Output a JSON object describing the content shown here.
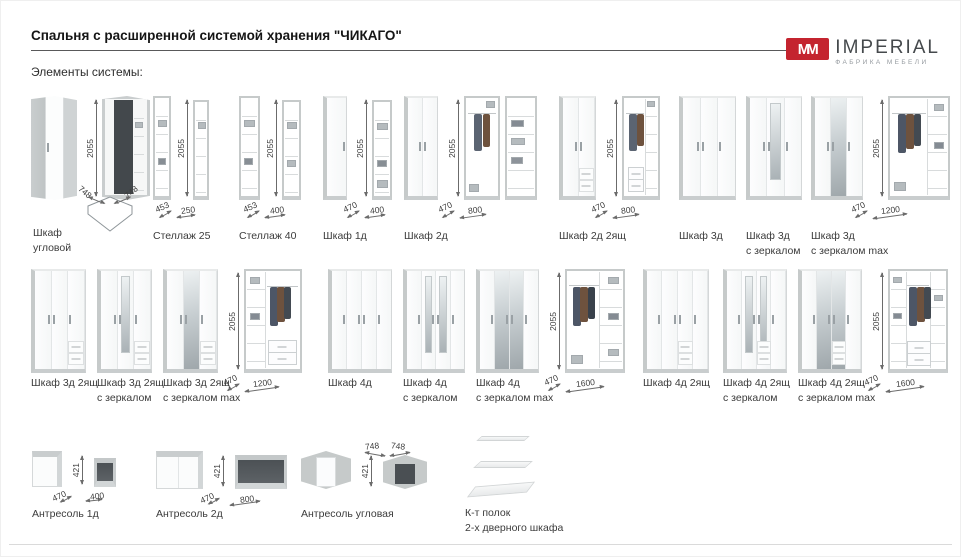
{
  "header": {
    "title": "Спальня с расширенной системой хранения \"ЧИКАГО\"",
    "subtitle": "Элементы системы:"
  },
  "brand": {
    "mark": "MM",
    "name": "IMPERIAL",
    "tagline": "ФАБРИКА МЕБЕЛИ"
  },
  "colors": {
    "accent_red": "#c4242f",
    "concrete_gray": "#c6caca",
    "mirror_gray": "#a9b1b5"
  },
  "items": {
    "r1": [
      {
        "l1": "Шкаф",
        "l2": "угловой",
        "h": "2055",
        "wA": "748",
        "wB": "748"
      },
      {
        "l1": "Стеллаж 25",
        "h": "2055",
        "d": "453",
        "w": "250"
      },
      {
        "l1": "Стеллаж 40",
        "h": "2055",
        "d": "453",
        "w": "400"
      },
      {
        "l1": "Шкаф 1д",
        "h": "2055",
        "d": "470",
        "w": "400"
      },
      {
        "l1": "Шкаф 2д",
        "h": "2055",
        "d": "470",
        "w": "800"
      },
      {
        "l1": "Шкаф 2д 2ящ",
        "h": "2055",
        "d": "470",
        "w": "800"
      },
      {
        "l1": "Шкаф 3д"
      },
      {
        "l1": "Шкаф 3д",
        "l2": "с зеркалом"
      },
      {
        "l1": "Шкаф 3д",
        "l2": "с зеркалом max",
        "h": "2055",
        "d": "470",
        "w": "1200"
      }
    ],
    "r2": [
      {
        "l1": "Шкаф 3д 2ящ"
      },
      {
        "l1": "Шкаф 3д 2ящ",
        "l2": "с зеркалом"
      },
      {
        "l1": "Шкаф 3д 2ящ",
        "l2": "с зеркалом max",
        "h": "2055",
        "d": "470",
        "w": "1200"
      },
      {
        "l1": "Шкаф 4д"
      },
      {
        "l1": "Шкаф 4д",
        "l2": "с зеркалом"
      },
      {
        "l1": "Шкаф 4д",
        "l2": "с зеркалом max",
        "h": "2055",
        "d": "470",
        "w": "1600"
      },
      {
        "l1": "Шкаф 4д 2ящ"
      },
      {
        "l1": "Шкаф 4д 2ящ",
        "l2": "с зеркалом"
      },
      {
        "l1": "Шкаф 4д 2ящ",
        "l2": "с зеркалом max",
        "h": "2055",
        "d": "470",
        "w": "1600"
      }
    ],
    "r3": [
      {
        "l1": "Антресоль 1д",
        "h": "421",
        "d": "470",
        "w": "400"
      },
      {
        "l1": "Антресоль 2д",
        "h": "421",
        "d": "470",
        "w": "800"
      },
      {
        "l1": "Антресоль угловая",
        "h": "421",
        "wA": "748",
        "wB": "748"
      },
      {
        "l1": "К-т полок",
        "l2": "2-х дверного шкафа"
      }
    ]
  }
}
